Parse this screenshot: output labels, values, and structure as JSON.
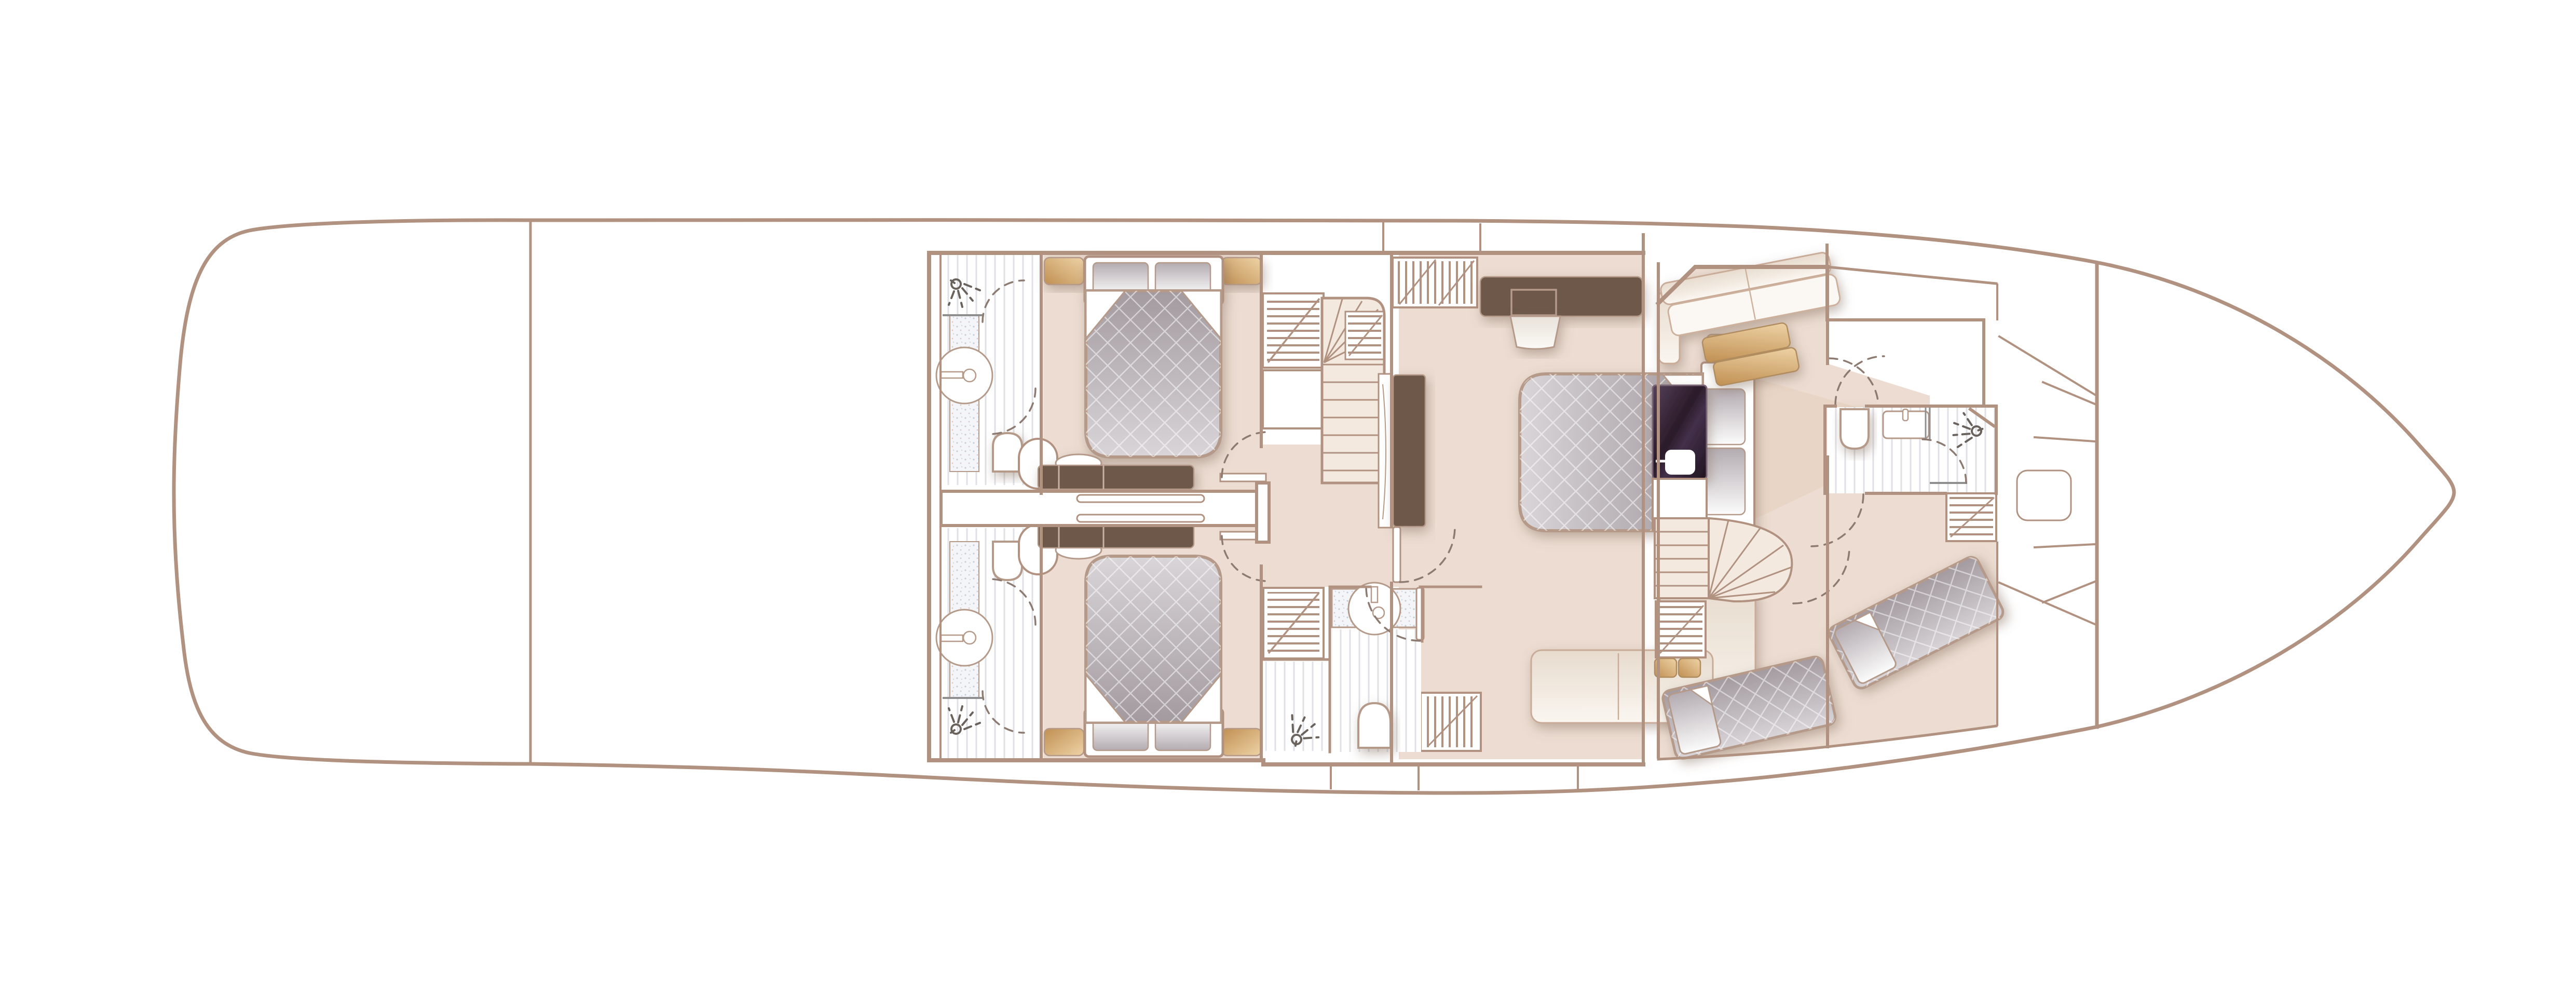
{
  "meta": {
    "title": "Motor yacht lower deck floor plan, top-down view, bow to the right",
    "view": "plan (top-down)",
    "orientation": "stern left, bow right"
  },
  "colors": {
    "line": "#b19180",
    "lineSoft": "#b59a8a",
    "floor": "#ecdcd1",
    "floorLight": "#f4ebe1",
    "wedge": "#e8d3c2",
    "stair": "#f3e9df",
    "darkWood": "#6d5849",
    "arc": "#8d7a70",
    "icon": "#6a625c",
    "rail": "#8f8f8f",
    "galleyDark": "#34222f",
    "tanWood": "#d8ad74",
    "mattressGray": "#b7afb4",
    "tileBlue": "#f3f5f8",
    "white": "#ffffff"
  },
  "plan": {
    "hull": {
      "name": "hull-outline",
      "stern": "rounded transom, left",
      "bow": "pointed, right"
    },
    "rooms": [
      {
        "name": "stern-deck",
        "furniture": []
      },
      {
        "name": "engine-room",
        "furniture": []
      },
      {
        "name": "guest-bathroom-port",
        "furniture": [
          "shower-head",
          "round-basin",
          "vanity-counter",
          "toilet",
          "door-swings"
        ]
      },
      {
        "name": "guest-bathroom-starboard",
        "furniture": [
          "shower-head",
          "round-basin",
          "vanity-counter",
          "toilet",
          "door-swings"
        ]
      },
      {
        "name": "guest-cabin-port",
        "furniture": [
          "double-bed",
          "two-pillows",
          "two-bedside-tables",
          "shelf-unit",
          "cupboard",
          "dressing-desk",
          "stool",
          "door-swing"
        ]
      },
      {
        "name": "guest-cabin-starboard",
        "furniture": [
          "double-bed",
          "two-pillows",
          "two-bedside-tables",
          "shelf-unit",
          "dressing-desk",
          "stool",
          "door-swing"
        ]
      },
      {
        "name": "central-lobby",
        "furniture": [
          "staircase-up",
          "sliding-door-wall",
          "pocket-doors"
        ]
      },
      {
        "name": "master-stateroom",
        "furniture": [
          "double-bed-head-forward",
          "two-pillows",
          "two-bedside-tables",
          "tv-panel",
          "dresser-with-tv",
          "stool",
          "hanging-wardrobe",
          "shelf-unit",
          "l-shaped-sofa"
        ]
      },
      {
        "name": "master-bathroom",
        "furniture": [
          "vanity-basin",
          "toilet",
          "shower",
          "shower-head",
          "door-swing"
        ]
      },
      {
        "name": "crew-mess-galley",
        "furniture": [
          "corner-settee",
          "folded-blankets",
          "galley-counter-dark",
          "sink",
          "curved-staircase",
          "shelf-unit",
          "seat-cushions"
        ]
      },
      {
        "name": "crew-cabin",
        "furniture": [
          "single-berth-aft",
          "single-berth-forward",
          "pillows"
        ]
      },
      {
        "name": "forward-bathroom",
        "furniture": [
          "toilet",
          "vanity-basin",
          "shower",
          "shower-head",
          "shelf-unit",
          "door-swings"
        ]
      },
      {
        "name": "forward-store",
        "furniture": []
      },
      {
        "name": "bow-locker",
        "furniture": [
          "deck-hatch"
        ]
      }
    ]
  }
}
